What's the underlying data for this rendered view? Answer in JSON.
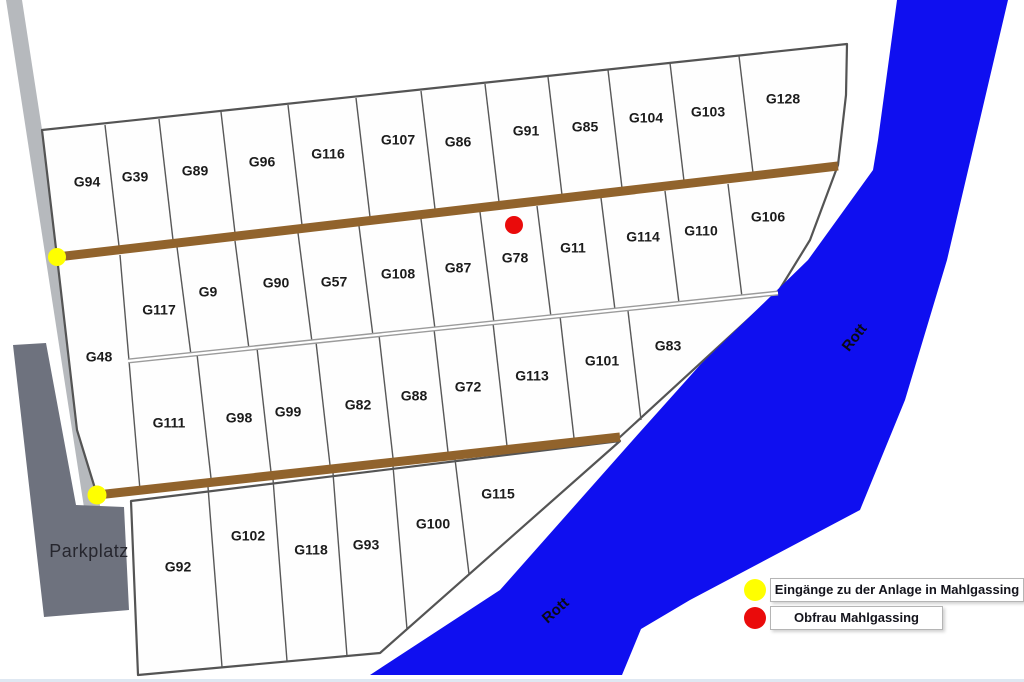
{
  "map": {
    "width": 1024,
    "height": 682,
    "colors": {
      "background": "#ffffff",
      "river": "#0f0ff0",
      "road": "#b6b9bd",
      "parkplatz": "#6e727e",
      "plot_fill": "#fefefe",
      "outline": "#545454",
      "divider": "#585858",
      "path_brown": "#91632c",
      "path_gray": "#9b9b9b",
      "dot_yellow": "#ffff00",
      "dot_red": "#ea0b0b"
    },
    "polygons": [
      {
        "name": "access-road",
        "fill": "road",
        "points": [
          [
            6,
            0
          ],
          [
            22,
            0
          ],
          [
            101,
            512
          ],
          [
            85,
            514
          ]
        ]
      },
      {
        "name": "parkplatz-area",
        "fill": "parkplatz",
        "points": [
          [
            13,
            345
          ],
          [
            46,
            343
          ],
          [
            76,
            505
          ],
          [
            124,
            507
          ],
          [
            129,
            610
          ],
          [
            44,
            617
          ]
        ]
      },
      {
        "name": "allotment-main-block",
        "fill": "plot_fill",
        "stroke": "outline",
        "stroke_width": 2.2,
        "points": [
          [
            42,
            130
          ],
          [
            847,
            44
          ],
          [
            846,
            95
          ],
          [
            838,
            165
          ],
          [
            810,
            240
          ],
          [
            778,
            292
          ],
          [
            620,
            437
          ],
          [
            97,
            495
          ],
          [
            77,
            430
          ],
          [
            57,
            257
          ]
        ]
      },
      {
        "name": "allotment-bottom-block",
        "fill": "plot_fill",
        "stroke": "outline",
        "stroke_width": 2.2,
        "points": [
          [
            131,
            501
          ],
          [
            620,
            441
          ],
          [
            380,
            653
          ],
          [
            138,
            675
          ]
        ]
      },
      {
        "name": "river-rott",
        "fill": "river",
        "points": [
          [
            897,
            0
          ],
          [
            1008,
            0
          ],
          [
            947,
            260
          ],
          [
            905,
            400
          ],
          [
            860,
            510
          ],
          [
            690,
            600
          ],
          [
            641,
            629
          ],
          [
            622,
            675
          ],
          [
            370,
            675
          ],
          [
            500,
            590
          ],
          [
            640,
            432
          ],
          [
            700,
            365
          ],
          [
            808,
            260
          ],
          [
            873,
            170
          ],
          [
            878,
            140
          ]
        ]
      }
    ],
    "dividers": {
      "row1": [
        [
          105,
          125,
          119,
          246
        ],
        [
          159,
          119,
          173,
          240
        ],
        [
          221,
          112,
          235,
          233
        ],
        [
          288,
          105,
          302,
          225
        ],
        [
          356,
          98,
          370,
          217
        ],
        [
          421,
          91,
          435,
          209
        ],
        [
          485,
          84,
          499,
          202
        ],
        [
          548,
          77,
          562,
          195
        ],
        [
          608,
          70,
          622,
          188
        ],
        [
          670,
          63,
          684,
          181
        ],
        [
          739,
          56,
          753,
          173
        ]
      ],
      "row2": [
        [
          177,
          247,
          191,
          355
        ],
        [
          235,
          241,
          249,
          349
        ],
        [
          298,
          233,
          312,
          342
        ],
        [
          359,
          226,
          373,
          336
        ],
        [
          421,
          219,
          435,
          329
        ],
        [
          480,
          212,
          494,
          323
        ],
        [
          537,
          206,
          551,
          317
        ],
        [
          601,
          198,
          615,
          310
        ],
        [
          665,
          191,
          679,
          303
        ],
        [
          728,
          184,
          742,
          297
        ]
      ],
      "row3": [
        [
          197,
          354,
          211,
          478
        ],
        [
          257,
          348,
          271,
          472
        ],
        [
          316,
          342,
          330,
          465
        ],
        [
          379,
          335,
          393,
          458
        ],
        [
          434,
          329,
          448,
          452
        ],
        [
          493,
          323,
          507,
          446
        ],
        [
          560,
          316,
          574,
          438
        ],
        [
          628,
          311,
          641,
          420
        ]
      ],
      "row4": [
        [
          208,
          487,
          222,
          667
        ],
        [
          273,
          479,
          287,
          661
        ],
        [
          333,
          473,
          347,
          656
        ],
        [
          393,
          466,
          407,
          629
        ],
        [
          455,
          459,
          469,
          574
        ]
      ],
      "g48_east_edge": [
        [
          120,
          255,
          140,
          490
        ]
      ]
    },
    "paths": [
      {
        "name": "middle-lane-outer",
        "pts": [
          128,
          361,
          778,
          293
        ],
        "color": "path_gray",
        "w": 5
      },
      {
        "name": "middle-lane-inner",
        "pts": [
          128,
          361,
          778,
          293
        ],
        "color": "#ffffff",
        "w": 2.2
      },
      {
        "name": "upper-brown-path",
        "pts": [
          57,
          257,
          838,
          166
        ],
        "color": "path_brown",
        "w": 9
      },
      {
        "name": "lower-brown-path",
        "pts": [
          97,
          495,
          620,
          437
        ],
        "color": "path_brown",
        "w": 9
      }
    ],
    "dots": [
      {
        "name": "entrance-dot-north",
        "color": "dot_yellow",
        "x": 57,
        "y": 257,
        "r": 9
      },
      {
        "name": "entrance-dot-south",
        "color": "dot_yellow",
        "x": 97,
        "y": 495,
        "r": 9.5
      },
      {
        "name": "obfrau-dot",
        "color": "dot_red",
        "x": 514,
        "y": 225,
        "r": 9
      }
    ],
    "river_labels": [
      {
        "text": "Rott",
        "x": 855,
        "y": 338,
        "rot": -52
      },
      {
        "text": "Rott",
        "x": 556,
        "y": 611,
        "rot": -42
      }
    ]
  },
  "plots": {
    "row1": [
      {
        "id": "G94",
        "x": 87,
        "y": 183
      },
      {
        "id": "G39",
        "x": 135,
        "y": 178
      },
      {
        "id": "G89",
        "x": 195,
        "y": 172
      },
      {
        "id": "G96",
        "x": 262,
        "y": 163
      },
      {
        "id": "G116",
        "x": 328,
        "y": 155
      },
      {
        "id": "G107",
        "x": 398,
        "y": 141
      },
      {
        "id": "G86",
        "x": 458,
        "y": 143
      },
      {
        "id": "G91",
        "x": 526,
        "y": 132
      },
      {
        "id": "G85",
        "x": 585,
        "y": 128
      },
      {
        "id": "G104",
        "x": 646,
        "y": 119
      },
      {
        "id": "G103",
        "x": 708,
        "y": 113
      },
      {
        "id": "G128",
        "x": 783,
        "y": 100
      }
    ],
    "row2": [
      {
        "id": "G117",
        "x": 159,
        "y": 311
      },
      {
        "id": "G9",
        "x": 208,
        "y": 293
      },
      {
        "id": "G90",
        "x": 276,
        "y": 284
      },
      {
        "id": "G57",
        "x": 334,
        "y": 283
      },
      {
        "id": "G108",
        "x": 398,
        "y": 275
      },
      {
        "id": "G87",
        "x": 458,
        "y": 269
      },
      {
        "id": "G78",
        "x": 515,
        "y": 259
      },
      {
        "id": "G11",
        "x": 573,
        "y": 249
      },
      {
        "id": "G114",
        "x": 643,
        "y": 238
      },
      {
        "id": "G110",
        "x": 701,
        "y": 232
      },
      {
        "id": "G106",
        "x": 768,
        "y": 218
      }
    ],
    "row3": [
      {
        "id": "G48",
        "x": 99,
        "y": 358
      },
      {
        "id": "G111",
        "x": 169,
        "y": 424
      },
      {
        "id": "G98",
        "x": 239,
        "y": 419
      },
      {
        "id": "G99",
        "x": 288,
        "y": 413
      },
      {
        "id": "G82",
        "x": 358,
        "y": 406
      },
      {
        "id": "G88",
        "x": 414,
        "y": 397
      },
      {
        "id": "G72",
        "x": 468,
        "y": 388
      },
      {
        "id": "G113",
        "x": 532,
        "y": 377
      },
      {
        "id": "G101",
        "x": 602,
        "y": 362
      },
      {
        "id": "G83",
        "x": 668,
        "y": 347
      }
    ],
    "row4": [
      {
        "id": "G92",
        "x": 178,
        "y": 568
      },
      {
        "id": "G102",
        "x": 248,
        "y": 537
      },
      {
        "id": "G118",
        "x": 311,
        "y": 551
      },
      {
        "id": "G93",
        "x": 366,
        "y": 546
      },
      {
        "id": "G100",
        "x": 433,
        "y": 525
      },
      {
        "id": "G115",
        "x": 498,
        "y": 495
      }
    ]
  },
  "parkplatz_label": {
    "text": "Parkplatz"
  },
  "legend": {
    "items": [
      {
        "color": "#ffff00",
        "label": "Eingänge zu der Anlage in Mahlgassing"
      },
      {
        "color": "#ea0b0b",
        "label": "Obfrau Mahlgassing"
      }
    ]
  }
}
